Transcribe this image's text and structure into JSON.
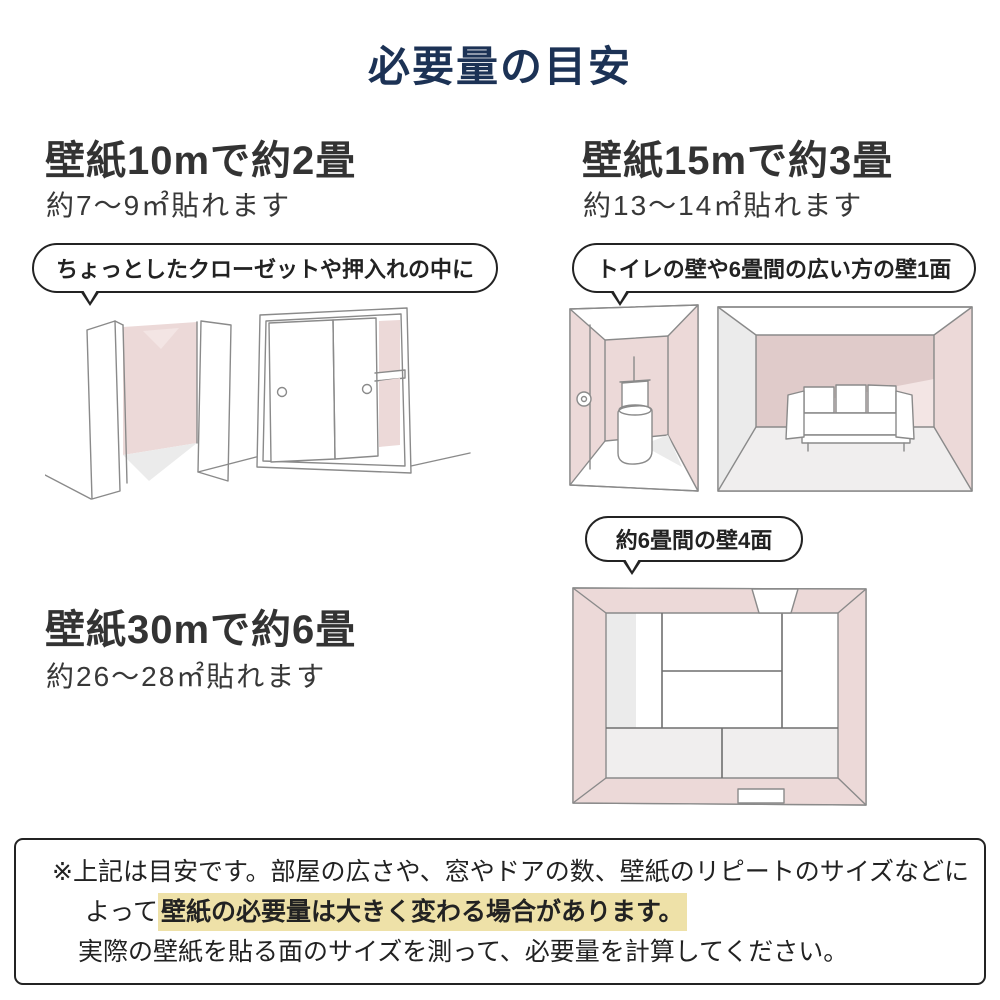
{
  "title": "必要量の目安",
  "sections": [
    {
      "id": "10m",
      "heading": "壁紙10mで約2畳",
      "subtext": "約7〜9㎡貼れます",
      "bubble": "ちょっとしたクローゼットや押入れの中に",
      "illustrations": [
        "open-closet",
        "sliding-closet"
      ]
    },
    {
      "id": "15m",
      "heading": "壁紙15mで約3畳",
      "subtext": "約13〜14㎡貼れます",
      "bubble": "トイレの壁や6畳間の広い方の壁1面",
      "illustrations": [
        "toilet-room",
        "sofa-room"
      ]
    },
    {
      "id": "30m",
      "heading": "壁紙30mで約6畳",
      "subtext": "約26〜28㎡貼れます",
      "bubble": "約6畳間の壁4面",
      "illustrations": [
        "tatami-room-floor-plan"
      ]
    }
  ],
  "note": {
    "line1": "※上記は目安です。部屋の広さや、窓やドアの数、壁紙のリピートのサイズなどに",
    "line2_prefix": "よって",
    "line2_highlight": "壁紙の必要量は大きく変わる場合があります。",
    "line3": "実際の壁紙を貼る面のサイズを測って、必要量を計算してください。"
  },
  "colors": {
    "title_navy": "#1c3255",
    "heading_dark": "#333333",
    "text_dark": "#222222",
    "wall_pink": "#ecd9d8",
    "wall_pink_light": "#f3e5e4",
    "wall_mauve": "#e0cbca",
    "shade_gray": "#ebebeb",
    "floor_gray": "#f0eeee",
    "highlight_yellow": "#eee1a8",
    "line_gray": "#8a8a8a",
    "border_dark": "#232323"
  }
}
